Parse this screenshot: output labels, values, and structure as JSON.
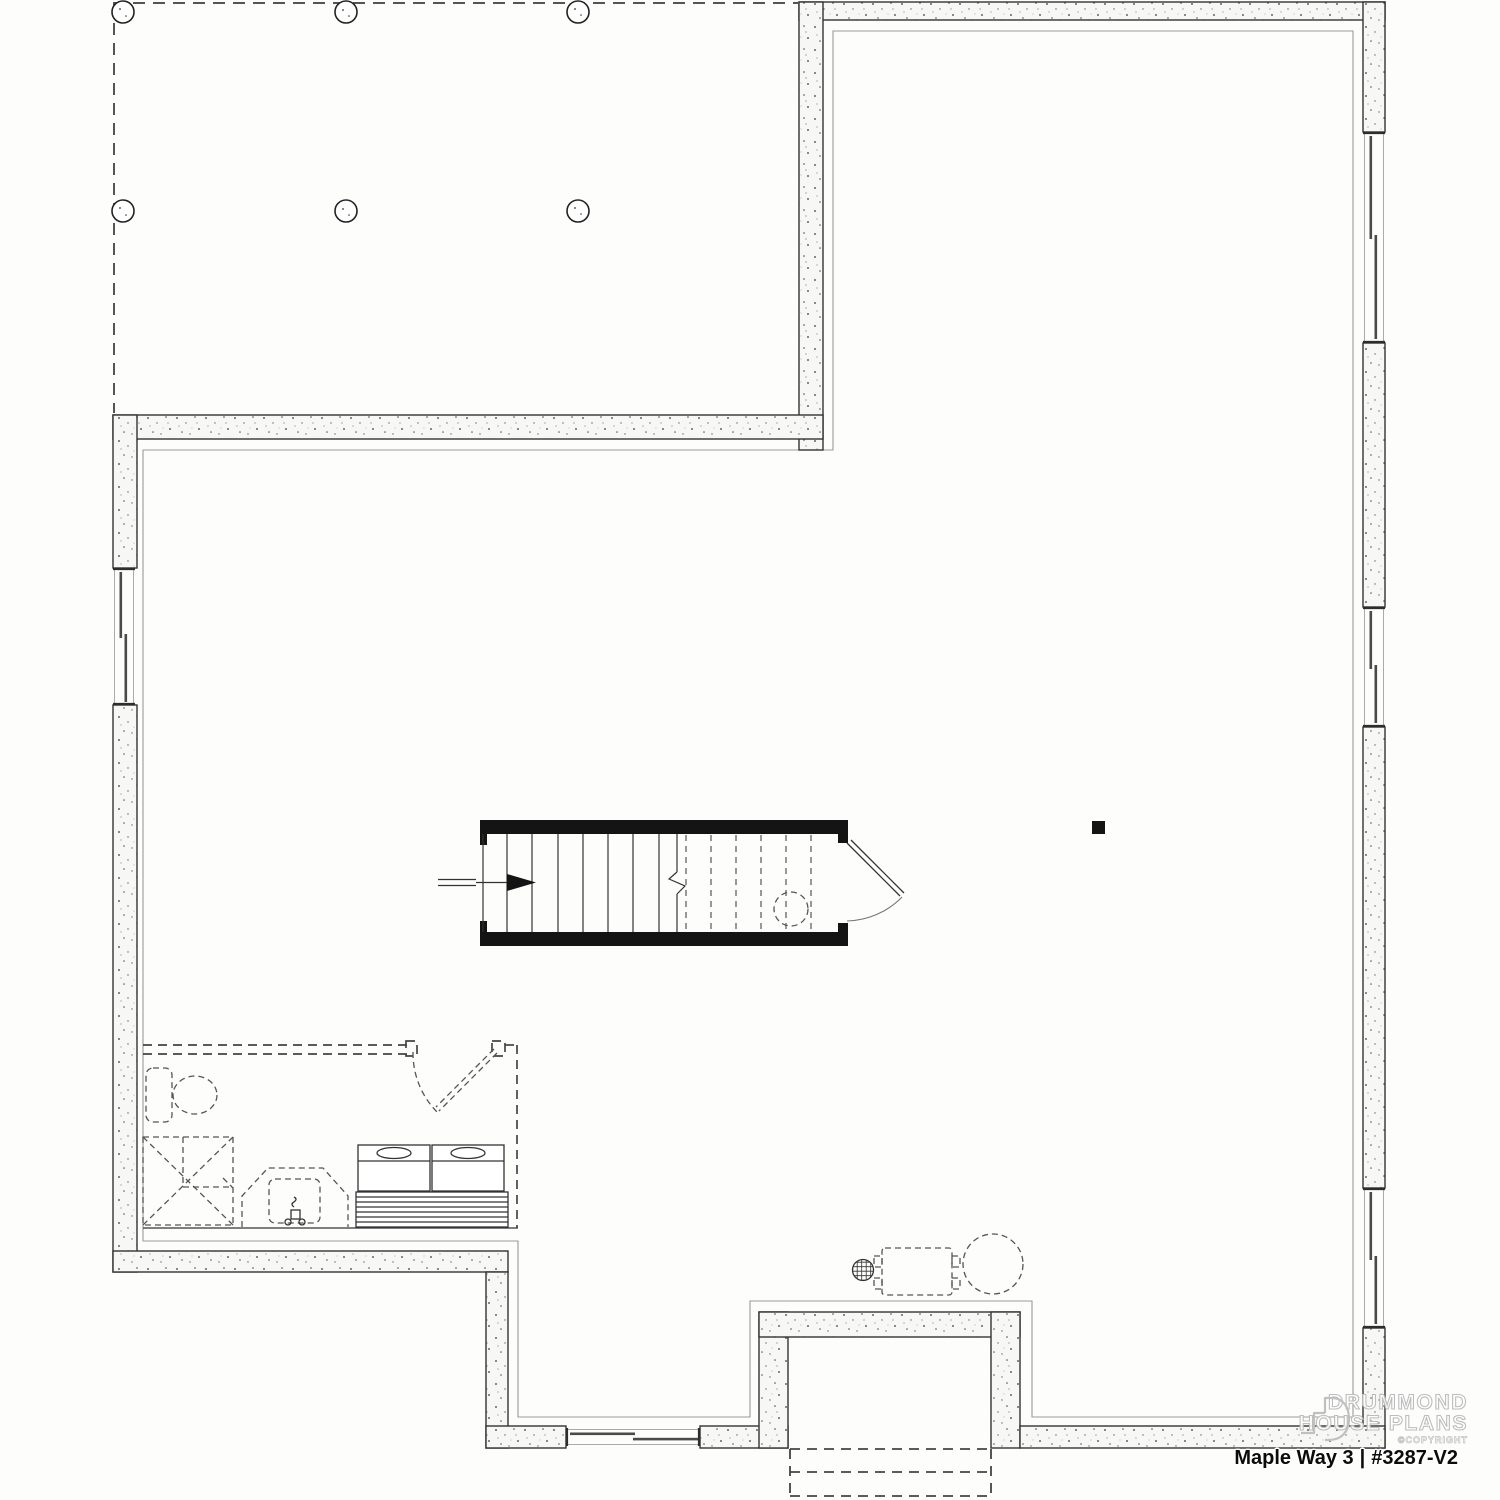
{
  "title_block": {
    "plan_name": "Maple Way 3",
    "divider": "|",
    "plan_number": "#3287-V2"
  },
  "watermark": {
    "line1": "DRUMMOND",
    "line2": "HOUSE PLANS",
    "copyright": "©COPYRIGHT"
  },
  "drawing": {
    "type": "basement-foundation-floor-plan",
    "colors": {
      "wall_line": "#333333",
      "wall_fill": "#f7f7f5",
      "dashed_line": "#555555",
      "finish_line": "#9a9a9a",
      "stair_black": "#141414",
      "background": "#fdfdfc"
    },
    "elements": [
      "unexcavated-area-with-six-piers",
      "concrete-foundation-walls",
      "five-slider-windows",
      "staircase-with-up-arrow-and-door",
      "future-bathroom-dashed-toilet-shower-vanity",
      "washer-dryer-on-platform",
      "floor-drain-furnace-water-heater",
      "garage-door-opening-dashed"
    ]
  }
}
